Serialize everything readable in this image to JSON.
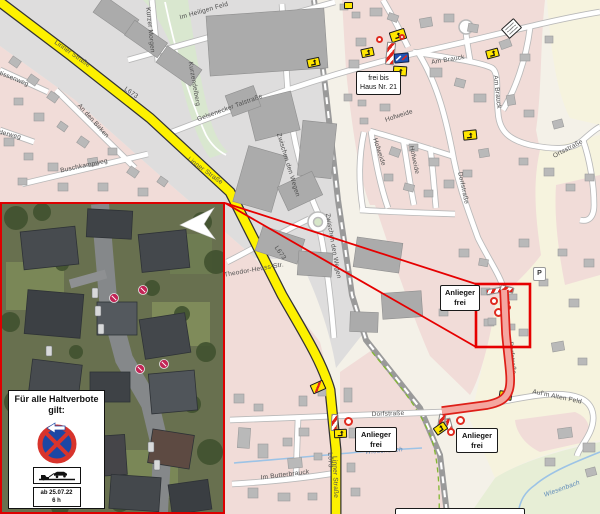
{
  "page": {
    "width": 600,
    "height": 514,
    "kind": "municipal road-closure map with aerial inset"
  },
  "colors": {
    "accent_red": "#e60000",
    "route_edge": "#de1f18",
    "route_fill": "#f4a7a0",
    "road_yellow": "#fdf100",
    "residential_pink": "#f1dcd8",
    "industrial_gray": "#dedddd",
    "field_pale": "#f6f3de",
    "green_area": "#e7eed6",
    "sign_yellow": "#ffe600",
    "no_stopping_blue": "#1c47a5",
    "water_blue": "#9cc3e6"
  },
  "icons": {
    "barrier": "road-closure-barrier",
    "no_entry": "no-entry-sign",
    "detour": "detour-arrow-sign",
    "detour_route": "detour-route-sign",
    "end_restriction": "end-of-restriction-sign",
    "direction_board": "blue-direction-sign",
    "no_stopping": "no-stopping-sign",
    "tow_away": "tow-away-zone-sign",
    "pointer": "pointer-arrow",
    "parking": "parking-icon"
  },
  "annotation_boxes": {
    "frei_bis": {
      "line1": "frei bis",
      "line2": "Haus Nr. 21"
    },
    "anlieger_1": {
      "line1": "Anlieger",
      "line2": "frei"
    },
    "anlieger_2": {
      "line1": "Anlieger",
      "line2": "frei"
    },
    "anlieger_3": {
      "line1": "Anlieger",
      "line2": "frei"
    }
  },
  "legend": {
    "title_line1": "Für alle Haltverbote",
    "title_line2": "gilt:",
    "date_line1": "ab 25.07.22",
    "date_line2": "6 h"
  },
  "map": {
    "parking_label": "P",
    "street_labels": [
      {
        "text": "Linner Straße",
        "x": 72,
        "y": 54,
        "rot": 35
      },
      {
        "text": "L673",
        "x": 131,
        "y": 93,
        "rot": 35
      },
      {
        "text": "Im Heiligen Feld",
        "x": 204,
        "y": 11,
        "rot": -16
      },
      {
        "text": "Kurzer Morgen",
        "x": 150,
        "y": 30,
        "rot": 84
      },
      {
        "text": "Kurzendelberg",
        "x": 194,
        "y": 84,
        "rot": 80
      },
      {
        "text": "Gelsenecker Talstraße",
        "x": 230,
        "y": 108,
        "rot": -20
      },
      {
        "text": "An den Birken",
        "x": 93,
        "y": 121,
        "rot": 48
      },
      {
        "text": "Buschkampweg",
        "x": 84,
        "y": 166,
        "rot": -12
      },
      {
        "text": "tissenweg",
        "x": 14,
        "y": 79,
        "rot": 22
      },
      {
        "text": "derweg",
        "x": 10,
        "y": 135,
        "rot": 14
      },
      {
        "text": "Linner Straße",
        "x": 205,
        "y": 171,
        "rot": 36
      },
      {
        "text": "Theodor-Heuss-Str.",
        "x": 254,
        "y": 270,
        "rot": -10
      },
      {
        "text": "Zwischen den Wegen",
        "x": 288,
        "y": 165,
        "rot": 73
      },
      {
        "text": "Zwischen den Wegen",
        "x": 333,
        "y": 246,
        "rot": 80
      },
      {
        "text": "L673",
        "x": 280,
        "y": 253,
        "rot": 55
      },
      {
        "text": "Linner Straße",
        "x": 335,
        "y": 477,
        "rot": 88
      },
      {
        "text": "L673",
        "x": 330,
        "y": 460,
        "rot": 88
      },
      {
        "text": "Im Butterbrauck",
        "x": 285,
        "y": 475,
        "rot": -7
      },
      {
        "text": "Dorfstraße",
        "x": 388,
        "y": 414,
        "rot": -2
      },
      {
        "text": "Dorfstraße",
        "x": 463,
        "y": 188,
        "rot": 78
      },
      {
        "text": "Dorfstraße",
        "x": 512,
        "y": 358,
        "rot": 84
      },
      {
        "text": "Auf'm Alten Feld",
        "x": 557,
        "y": 397,
        "rot": 12
      },
      {
        "text": "Am Brauck",
        "x": 448,
        "y": 60,
        "rot": -9
      },
      {
        "text": "Am Brauck",
        "x": 497,
        "y": 92,
        "rot": 84
      },
      {
        "text": "Hofweide",
        "x": 399,
        "y": 116,
        "rot": -18
      },
      {
        "text": "Hofweide",
        "x": 379,
        "y": 152,
        "rot": 72
      },
      {
        "text": "Hofweide",
        "x": 414,
        "y": 160,
        "rot": 78
      },
      {
        "text": "Ortsstraße",
        "x": 568,
        "y": 149,
        "rot": -28
      },
      {
        "text": "Wiesenbach",
        "x": 384,
        "y": 451,
        "rot": -4,
        "kind": "water"
      },
      {
        "text": "Wiesenbach",
        "x": 562,
        "y": 489,
        "rot": -20,
        "kind": "water"
      }
    ]
  }
}
